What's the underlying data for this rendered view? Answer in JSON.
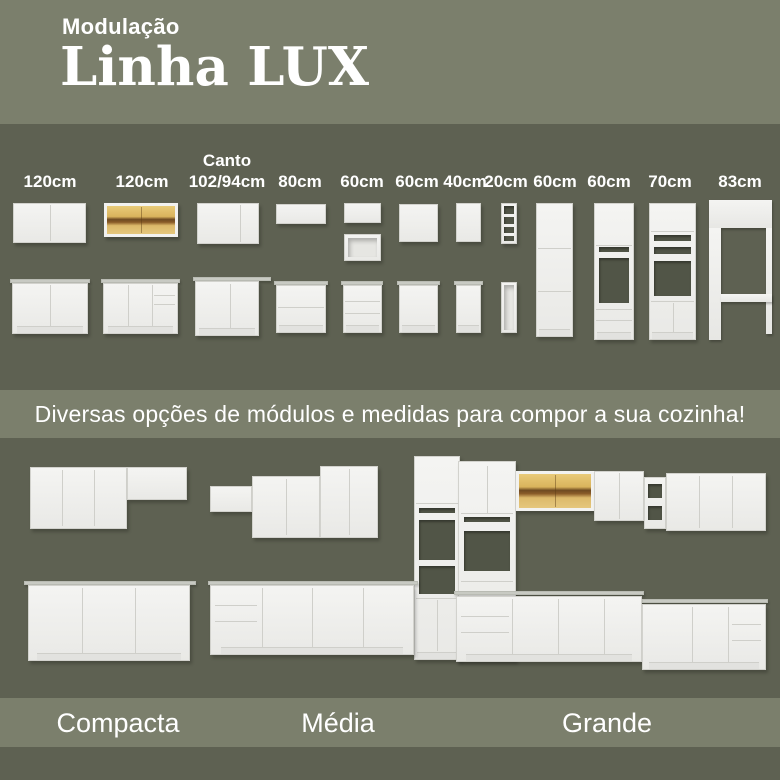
{
  "theme": {
    "band_light": "#7b7f6c",
    "band_dark": "#5e6152",
    "text": "#ffffff",
    "cabinet_white": "#f1f1ef",
    "countertop_gray": "#c8cac3",
    "glass_amber": "#d9b35c"
  },
  "header": {
    "kicker": "Modulação",
    "title": "Linha LUX"
  },
  "modules": {
    "items": [
      {
        "line1": "120cm"
      },
      {
        "line1": "120cm"
      },
      {
        "line1": "Canto",
        "line2": "102/94cm"
      },
      {
        "line1": "80cm"
      },
      {
        "line1": "60cm"
      },
      {
        "line1": "60cm"
      },
      {
        "line1": "40cm"
      },
      {
        "line1": "20cm"
      },
      {
        "line1": "60cm"
      },
      {
        "line1": "60cm"
      },
      {
        "line1": "70cm"
      },
      {
        "line1": "83cm"
      }
    ]
  },
  "banner": {
    "text": "Diversas opções de módulos e medidas para compor a sua cozinha!"
  },
  "kitchens": [
    {
      "name": "Compacta"
    },
    {
      "name": "Média"
    },
    {
      "name": "Grande"
    }
  ]
}
